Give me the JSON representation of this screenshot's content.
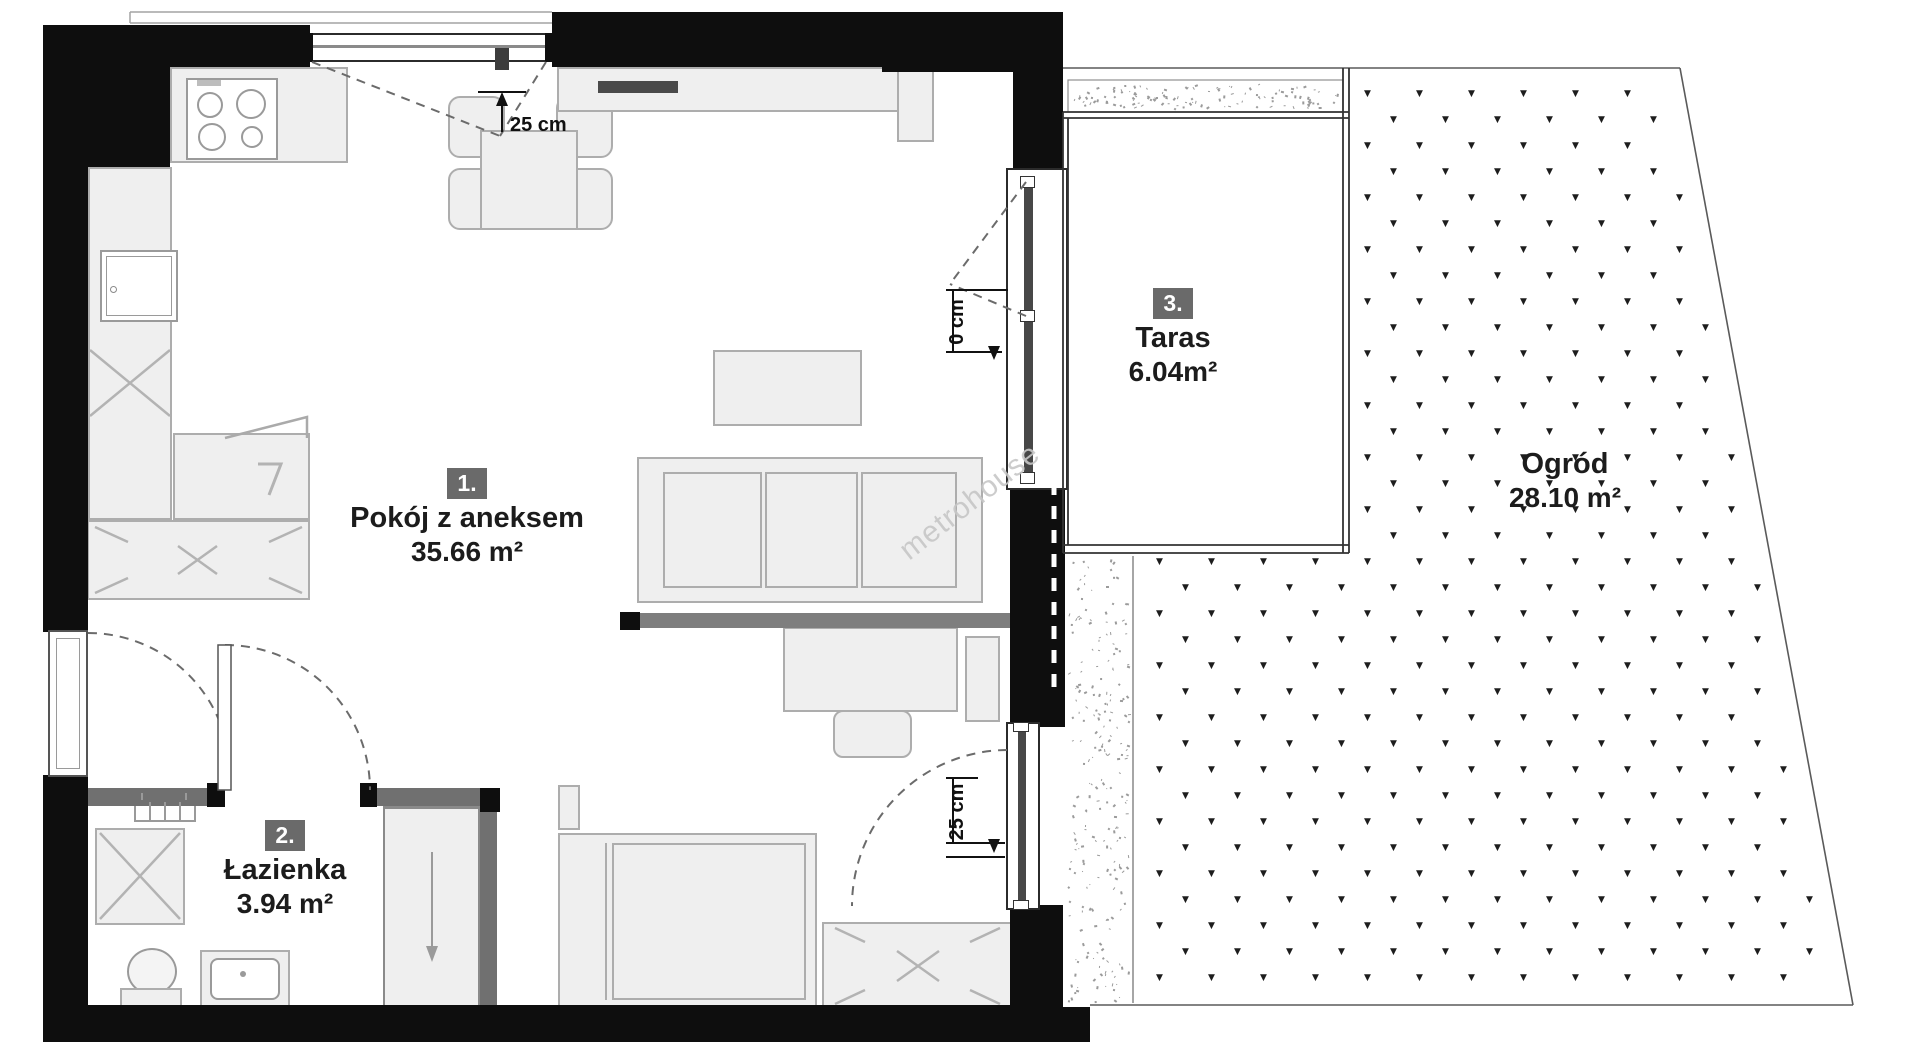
{
  "rooms": [
    {
      "number": "1.",
      "name": "Pokój z aneksem",
      "area": "35.66 m²"
    },
    {
      "number": "2.",
      "name": "Łazienka",
      "area": "3.94 m²"
    },
    {
      "number": "3.",
      "name": "Taras",
      "area": "6.04m²"
    }
  ],
  "garden": {
    "name": "Ogród",
    "area": "28.10 m²"
  },
  "dims": {
    "top_window": "25 cm",
    "balcony_door": "0 cm",
    "bottom_window": "25 cm"
  },
  "watermark": "metrohouse",
  "colors": {
    "wall": "#0e0e0e",
    "partition": "#707070",
    "furniture_fill": "#efefef",
    "furniture_line": "#adadad",
    "badge_bg": "#6a6a6a",
    "grass_mark": "#1d1d1d",
    "watermark_gray": "#c7c7c7"
  }
}
